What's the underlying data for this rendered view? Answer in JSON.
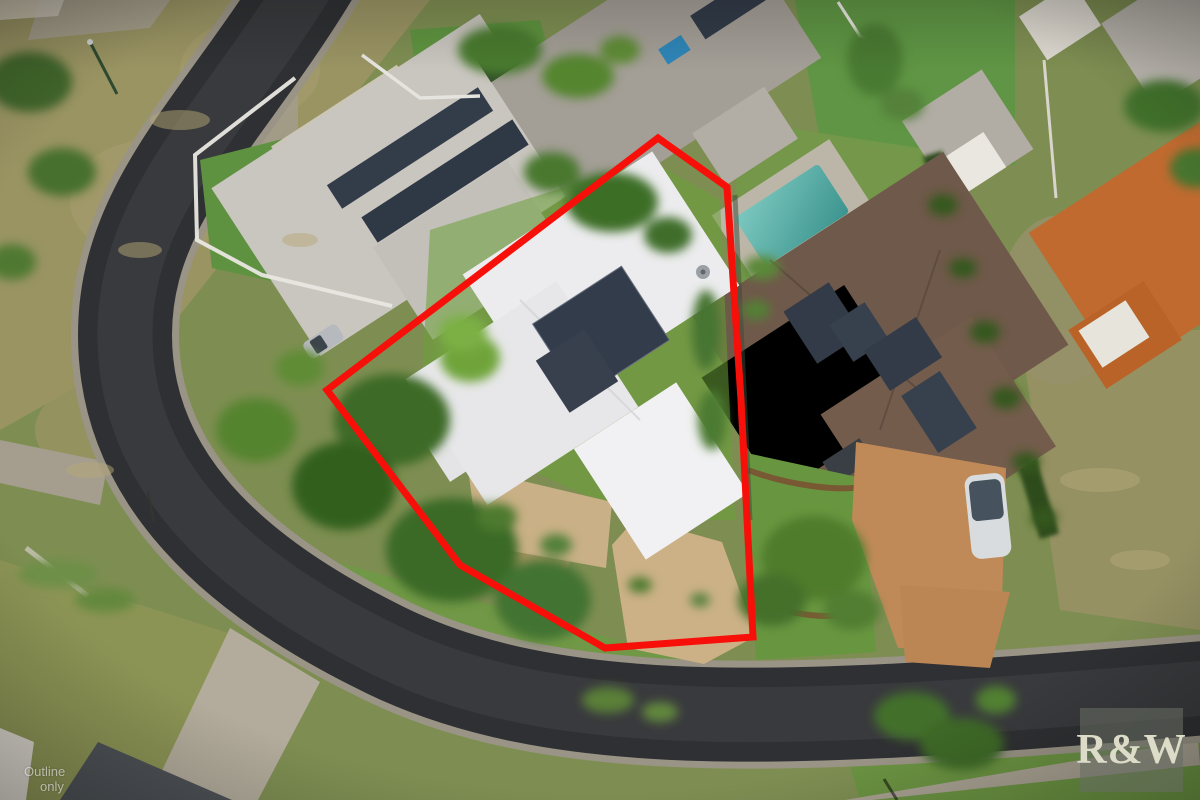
{
  "scene": {
    "boundary": {
      "points": "658,138 727,187 741,400 753,637 605,648 460,565 327,390",
      "color": "#f7100a"
    },
    "watermark": {
      "line1": "Outline",
      "line2": "only"
    },
    "logo": {
      "text": "R&W"
    },
    "colors": {
      "road": "#2f3033",
      "concrete": "#a59e90",
      "grass_base": "#7e8e52",
      "grass_bright": "#619542",
      "grass_dry": "#a09767",
      "subject_roof": "#ececee",
      "nw_roof": "#c9c5bf",
      "n_roof": "#a39e96",
      "e_roof": "#6f594a",
      "far_roof": "#c06a30",
      "pool_blue": "#2f93c8",
      "pool_teal": "#52a8a2",
      "solar": "#333c4a",
      "driveway_paver": "#ccb187",
      "driveway_gravel": "#c08a58"
    }
  }
}
